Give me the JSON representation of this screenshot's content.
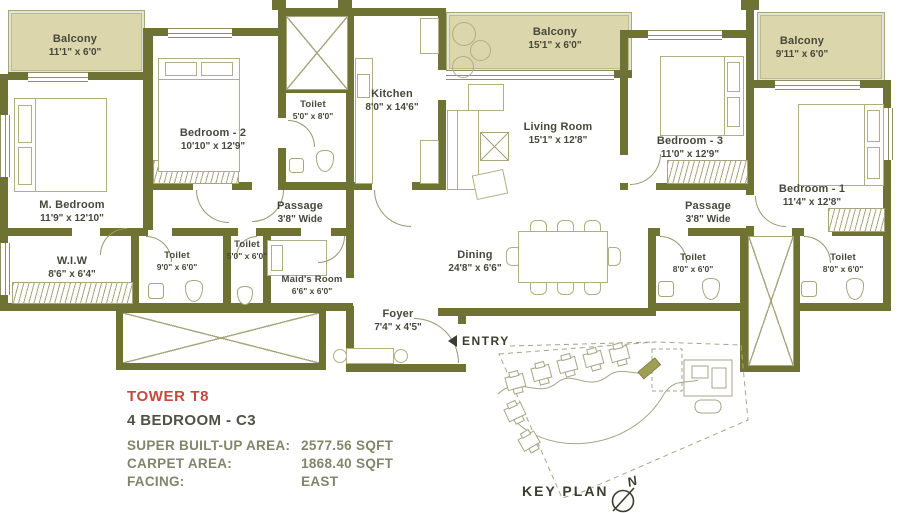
{
  "rooms": {
    "balcony_left": {
      "name": "Balcony",
      "dims": "11'1\" x 6'0\""
    },
    "bedroom2": {
      "name": "Bedroom - 2",
      "dims": "10'10\" x 12'9\""
    },
    "toilet_kitchen": {
      "name": "Toilet",
      "dims": "5'0\" x 8'0\""
    },
    "kitchen": {
      "name": "Kitchen",
      "dims": "8'0\" x 14'6\""
    },
    "balcony_mid": {
      "name": "Balcony",
      "dims": "15'1\" x 6'0\""
    },
    "living": {
      "name": "Living Room",
      "dims": "15'1\" x 12'8\""
    },
    "bedroom3": {
      "name": "Bedroom - 3",
      "dims": "11'0\" x 12'9\""
    },
    "balcony_right": {
      "name": "Balcony",
      "dims": "9'11\" x 6'0\""
    },
    "bedroom1": {
      "name": "Bedroom - 1",
      "dims": "11'4\" x 12'8\""
    },
    "m_bedroom": {
      "name": "M. Bedroom",
      "dims": "11'9\" x 12'10\""
    },
    "passage_left": {
      "name": "Passage",
      "dims": "3'8\" Wide"
    },
    "passage_right": {
      "name": "Passage",
      "dims": "3'8\" Wide"
    },
    "wiw": {
      "name": "W.I.W",
      "dims": "8'6\" x 6'4\""
    },
    "toilet_master": {
      "name": "Toilet",
      "dims": "9'0\" x 6'0\""
    },
    "toilet_maid": {
      "name": "Toilet",
      "dims": "5'0\" x 6'0\""
    },
    "maids_room": {
      "name": "Maid's Room",
      "dims": "6'6\" x 6'0\""
    },
    "dining": {
      "name": "Dining",
      "dims": "24'8\" x 6'6\""
    },
    "foyer": {
      "name": "Foyer",
      "dims": "7'4\" x 4'5\""
    },
    "toilet_bed1a": {
      "name": "Toilet",
      "dims": "8'0\" x 6'0\""
    },
    "toilet_bed1b": {
      "name": "Toilet",
      "dims": "8'0\" x 6'0\""
    }
  },
  "plan": {
    "entry_label": "ENTRY",
    "keyplan_label": "KEY PLAN",
    "north_label": "N"
  },
  "info": {
    "tower": "TOWER T8",
    "unit_type": "4 BEDROOM - C3",
    "rows": [
      {
        "label": "SUPER BUILT-UP AREA:",
        "value": "2577.56 SQFT"
      },
      {
        "label": "CARPET AREA:",
        "value": "1868.40 SQFT"
      },
      {
        "label": "FACING:",
        "value": "EAST"
      }
    ]
  },
  "colors": {
    "wall": "#6e7233",
    "balcony_fill": "#dcd6ac",
    "accent_red": "#c4483c",
    "olive_text": "#83856a",
    "dark_text": "#45483a",
    "sketch": "#b2af8e"
  }
}
